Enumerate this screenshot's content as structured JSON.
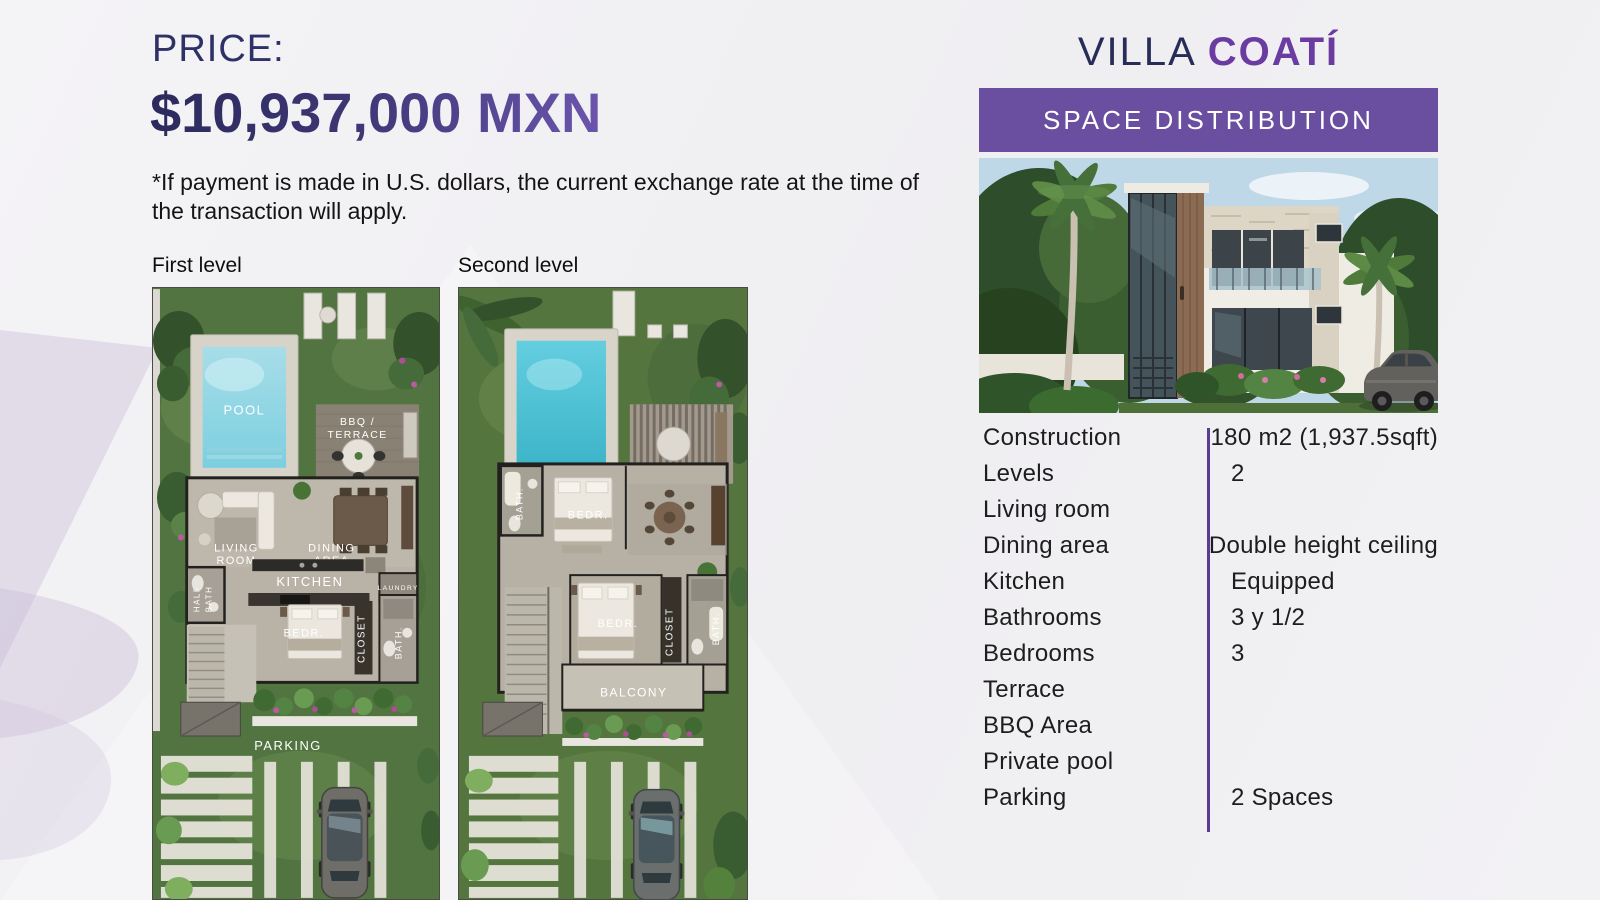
{
  "pricing": {
    "label": "PRICE:",
    "value": "$10,937,000 MXN",
    "disclaimer": "*If payment is made in U.S. dollars, the current exchange rate at the time of the transaction will apply."
  },
  "plans": {
    "first_label": "First level",
    "second_label": "Second level"
  },
  "villa": {
    "title_regular": "VILLA",
    "title_bold": "COATÍ",
    "banner": "SPACE DISTRIBUTION"
  },
  "specs": {
    "rows": [
      {
        "label": "Construction",
        "value": "180 m2 (1,937.5sqft)"
      },
      {
        "label": "Levels",
        "value": "2"
      },
      {
        "label": "Living room",
        "value": ""
      },
      {
        "label": "Dining area",
        "value": "Double height ceiling"
      },
      {
        "label": "Kitchen",
        "value": "Equipped"
      },
      {
        "label": "Bathrooms",
        "value": "3 y 1/2"
      },
      {
        "label": "Bedrooms",
        "value": "3"
      },
      {
        "label": "Terrace",
        "value": ""
      },
      {
        "label": "BBQ Area",
        "value": ""
      },
      {
        "label": "Private pool",
        "value": ""
      },
      {
        "label": "Parking",
        "value": "2 Spaces"
      }
    ]
  },
  "plan1": {
    "pool": "POOL",
    "bbq_line1": "BBQ /",
    "bbq_line2": "TERRACE",
    "living_line1": "LIVING",
    "living_line2": "ROOM",
    "dining_line1": "DINING",
    "dining_line2": "AREA",
    "kitchen": "KITCHEN",
    "laundry": "LAUNDRY",
    "half_bath_line1": "HALF",
    "half_bath_line2": "BATH",
    "bedroom": "BEDR.",
    "closet": "CLOSET",
    "bath": "BATH.",
    "parking": "PARKING"
  },
  "plan2": {
    "bath_upper": "BATH.",
    "bedroom_upper": "BEDR.",
    "bedroom_main": "BEDR.",
    "closet": "CLOSET",
    "bath": "BATH.",
    "balcony": "BALCONY"
  },
  "colors": {
    "accent_purple": "#6a4fa0",
    "title_navy": "#272c59",
    "title_purple": "#6a3ba1",
    "price_gradient_from": "#2b2a5c",
    "price_gradient_to": "#6b55ad",
    "divider_purple": "#5b3d8f",
    "pool_blue": "#7ccfe0",
    "grass_green": "#55753f"
  }
}
